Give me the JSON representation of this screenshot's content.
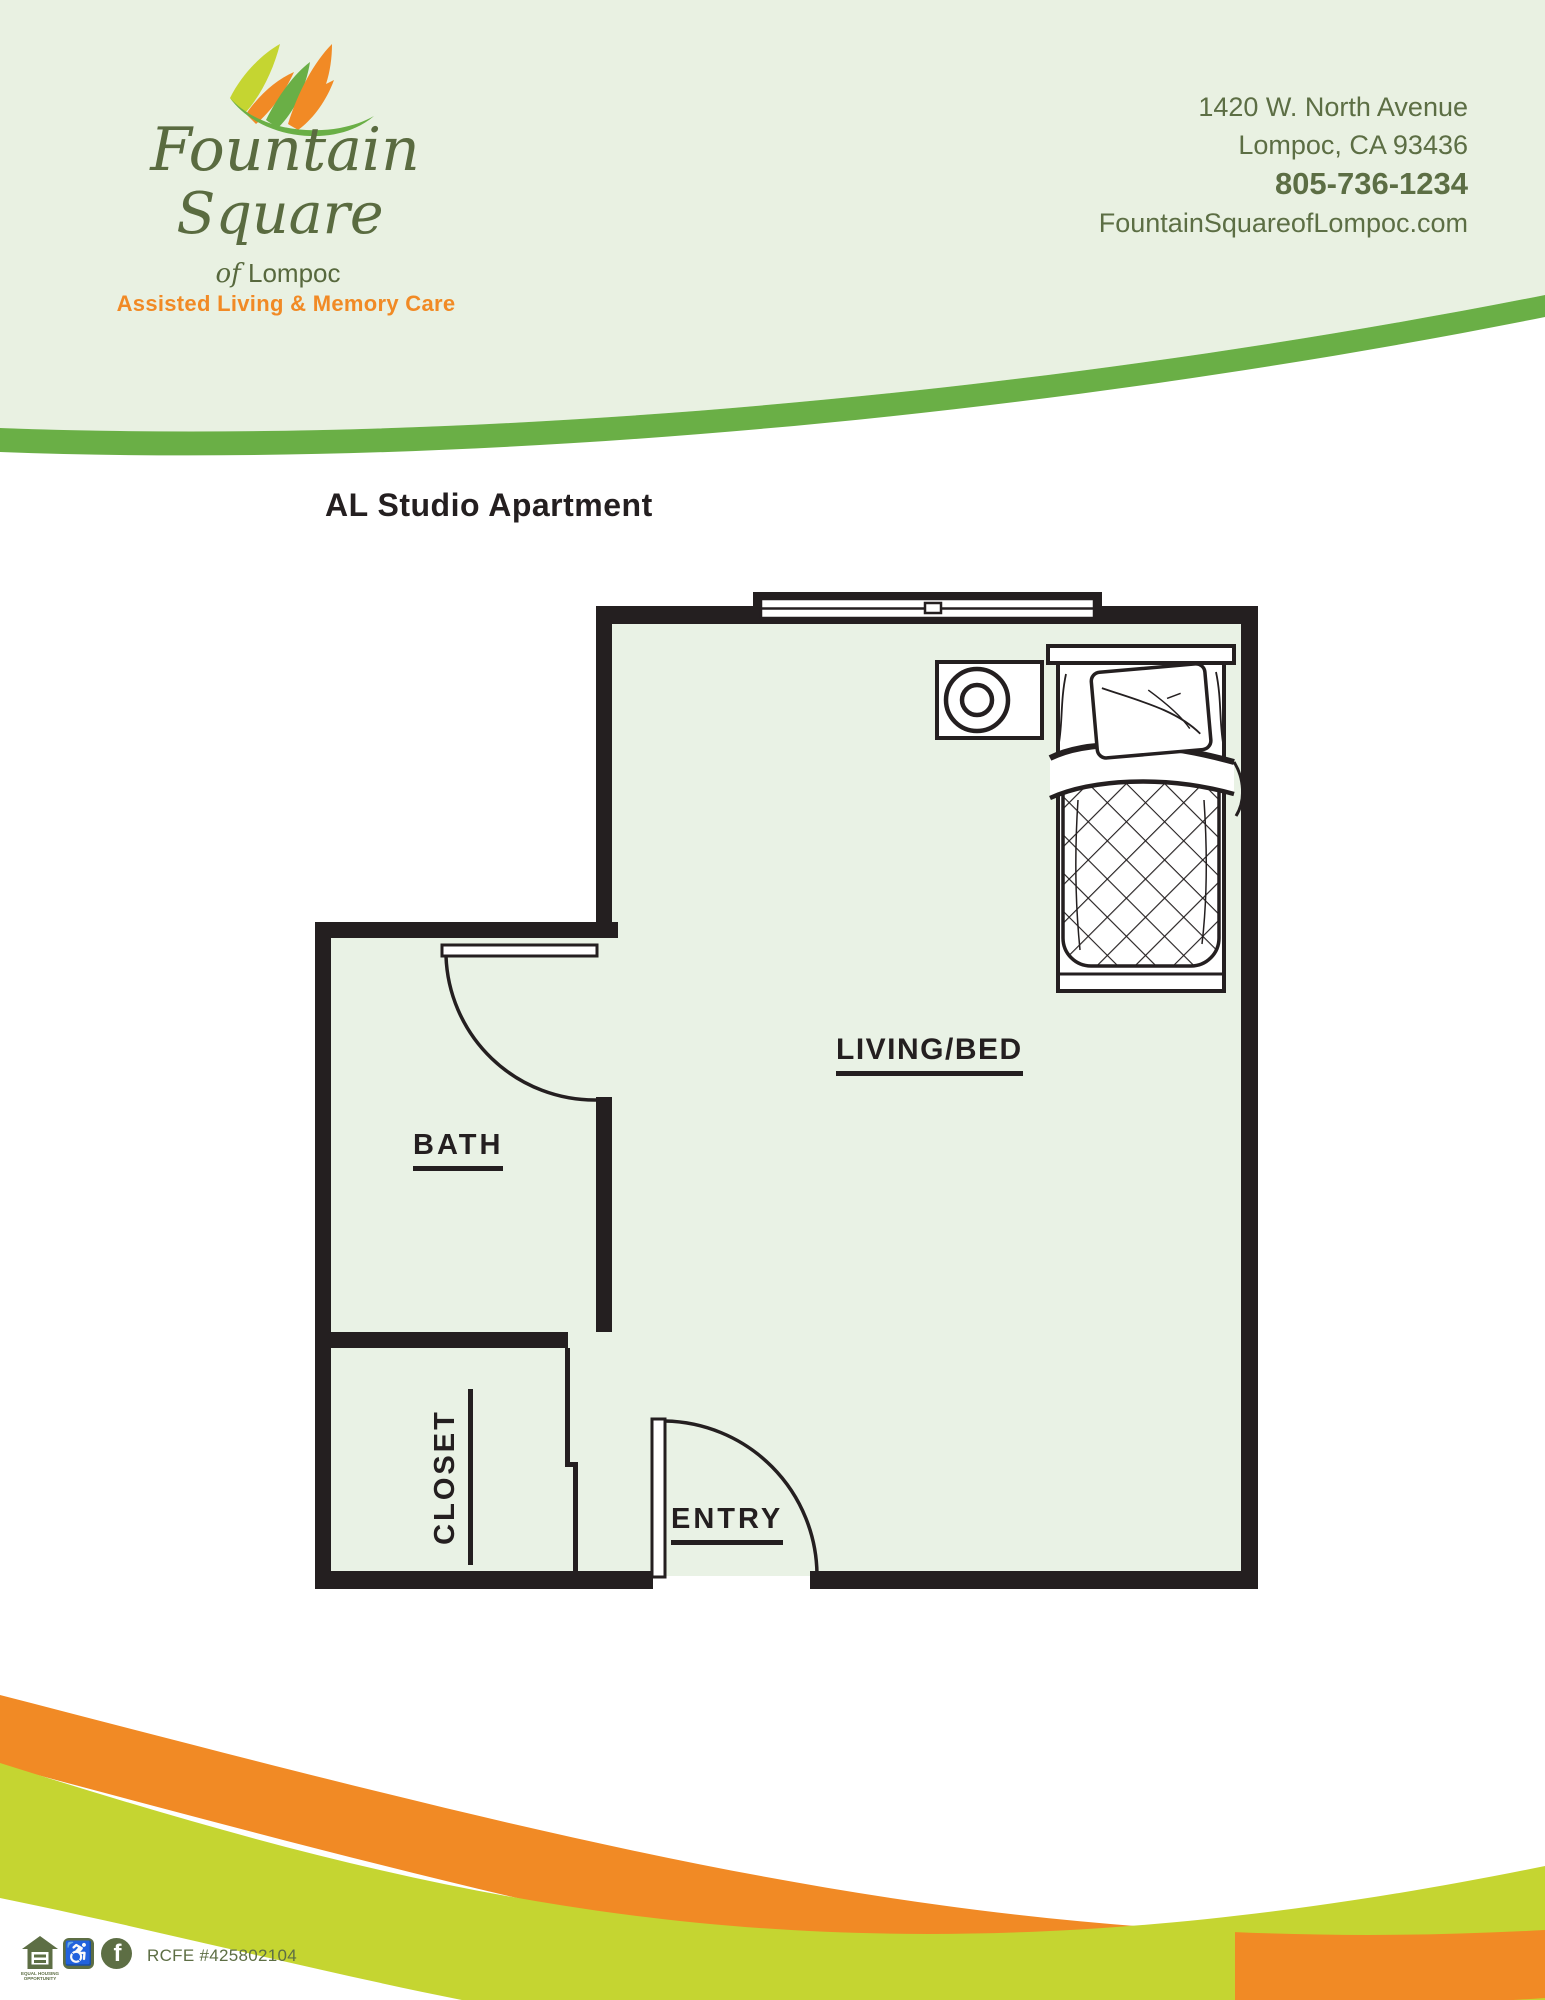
{
  "brand": {
    "name_line1": "Fountain",
    "name_line2": "Square",
    "location_prefix": "of",
    "location_name": "Lompoc",
    "tagline": "Assisted Living & Memory Care",
    "logo_icon": "fountain-leaves-icon"
  },
  "contact": {
    "address_line1": "1420 W. North Avenue",
    "address_line2": "Lompoc, CA 93436",
    "phone": "805-736-1234",
    "website": "FountainSquareofLompoc.com"
  },
  "floor_plan": {
    "title": "AL Studio Apartment",
    "labels": {
      "living": "LIVING/BED",
      "bath": "BATH",
      "closet": "CLOSET",
      "entry": "ENTRY"
    },
    "features": [
      "window",
      "bath-door",
      "entry-door",
      "bed",
      "nightstand"
    ]
  },
  "footer": {
    "license": "RCFE #425802104",
    "equal_housing_caption": "EQUAL HOUSING OPPORTUNITY",
    "icons": [
      "equal-housing-icon",
      "accessibility-icon",
      "facebook-icon"
    ]
  },
  "colors": {
    "header_bg": "#e9f1e2",
    "brand_green": "#6aaf46",
    "dark_olive": "#5c6e44",
    "orange": "#f18a25",
    "chartreuse": "#c5d531",
    "wall_black": "#241f20",
    "floor_fill": "#e9f2e5"
  }
}
